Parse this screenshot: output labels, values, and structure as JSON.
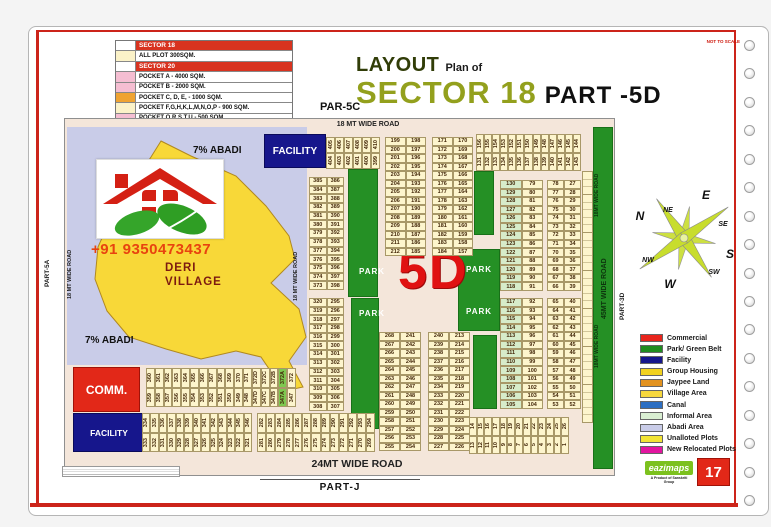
{
  "header": {
    "not_to_scale": "NOT TO SCALE",
    "title_layout": "LAYOUT",
    "title_plan_of": "Plan of",
    "title_sector": "SECTOR 18",
    "title_part": "PART -5D",
    "par5c": "PAR-5C"
  },
  "legend_left": {
    "sections": [
      {
        "header": "SECTOR 18",
        "rows": [
          {
            "label": "ALL PLOT  300SQM.",
            "color": "#fbf2c8"
          }
        ]
      },
      {
        "header": "SECTOR 20",
        "rows": [
          {
            "label": "POCKET A    -  4000 SQM.",
            "color": "#f5bed2"
          },
          {
            "label": "POCKET B    -  2000 SQM.",
            "color": "#f5bed2"
          },
          {
            "label": "POCKET C, D, E,  - 1000 SQM.",
            "color": "#efa332"
          },
          {
            "label": "POCKET  F,G,H,K,L,M,N,O,P  -  900 SQM.",
            "color": "#fbf2c8"
          },
          {
            "label": "POCKET Q,R,S,T,U   -  500 SQM.",
            "color": "#f5bed2"
          }
        ]
      }
    ]
  },
  "legend_right": {
    "items": [
      {
        "label": "Commercial",
        "color": "#e8251c"
      },
      {
        "label": "Park/ Green Belt",
        "color": "#1f8c1f"
      },
      {
        "label": "Facility",
        "color": "#16168c"
      },
      {
        "label": "Group Housing",
        "color": "#f2d21f"
      },
      {
        "label": "Jaypee Land",
        "color": "#e2921f"
      },
      {
        "label": "Village Area",
        "color": "#f6d73e"
      },
      {
        "label": "Canal",
        "color": "#2d6fc2"
      },
      {
        "label": "Informal Area",
        "color": "#d9efd2"
      },
      {
        "label": "Abadi Area",
        "color": "#c9cce8"
      },
      {
        "label": "Unalloted Plots",
        "color": "#f2e435"
      },
      {
        "label": "New Relocated Plots",
        "color": "#e215a0"
      }
    ]
  },
  "sides": {
    "part5a": "PART-5A",
    "part3d": "PART-3D"
  },
  "compass": {
    "n": "N",
    "ne": "NE",
    "e": "E",
    "se": "SE",
    "s": "S",
    "sw": "SW",
    "w": "W",
    "nw": "NW"
  },
  "footer": {
    "part_j": "PART-J",
    "brand": "eazimaps",
    "tagline": "A Product of Sanskriti Group",
    "page_no": "17"
  },
  "map": {
    "labels": {
      "top_road": "18 MT WIDE ROAD",
      "left_road": "18 MT WIDE ROAD",
      "mid_road": "18 MT WIDE ROAD",
      "right_18_top": "18MT WIDE ROAD",
      "right_18_bot": "18MT WIDE ROAD",
      "right_45": "45MT WIDE ROAD",
      "bottom_road": "24MT WIDE ROAD",
      "park": "PARK",
      "big_5d": "5D",
      "facility_top": "FACILITY",
      "comm": "COMM.",
      "facility_bottom": "FACILITY",
      "deri1": "DERI",
      "deri2": "VILLAGE",
      "abadi_top": "7% ABADI",
      "abadi_bottom": "7% ABADI",
      "phone": "+91 9350473437"
    },
    "plots": {
      "top_strip": {
        "dir": "v",
        "pairs": [
          [
            "405",
            "404"
          ],
          [
            "406",
            "403"
          ],
          [
            "407",
            "402"
          ],
          [
            "408",
            "401"
          ],
          [
            "409",
            "400"
          ],
          [
            "410",
            "399"
          ]
        ]
      },
      "colA": {
        "dir": "h",
        "pairs": [
          [
            "385",
            "386"
          ],
          [
            "384",
            "387"
          ],
          [
            "383",
            "388"
          ],
          [
            "382",
            "389"
          ],
          [
            "381",
            "390"
          ],
          [
            "380",
            "391"
          ],
          [
            "379",
            "392"
          ],
          [
            "378",
            "393"
          ],
          [
            "377",
            "394"
          ],
          [
            "376",
            "395"
          ],
          [
            "375",
            "396"
          ],
          [
            "374",
            "397"
          ],
          [
            "373",
            "398"
          ]
        ]
      },
      "colB": {
        "dir": "h",
        "pairs": [
          [
            "320",
            "295"
          ],
          [
            "319",
            "296"
          ],
          [
            "318",
            "297"
          ],
          [
            "317",
            "298"
          ],
          [
            "316",
            "299"
          ],
          [
            "315",
            "300"
          ],
          [
            "314",
            "301"
          ],
          [
            "313",
            "302"
          ],
          [
            "312",
            "303"
          ],
          [
            "311",
            "304"
          ],
          [
            "310",
            "305"
          ],
          [
            "309",
            "306"
          ],
          [
            "308",
            "307"
          ]
        ]
      },
      "colC": {
        "dir": "h",
        "pairs": [
          [
            "199",
            "198"
          ],
          [
            "200",
            "197"
          ],
          [
            "201",
            "196"
          ],
          [
            "202",
            "195"
          ],
          [
            "203",
            "194"
          ],
          [
            "204",
            "193"
          ],
          [
            "205",
            "192"
          ],
          [
            "206",
            "191"
          ],
          [
            "207",
            "190"
          ],
          [
            "208",
            "189"
          ],
          [
            "209",
            "188"
          ],
          [
            "210",
            "187"
          ],
          [
            "211",
            "186"
          ],
          [
            "212",
            "185"
          ]
        ]
      },
      "colD": {
        "dir": "h",
        "pairs": [
          [
            "171",
            "170"
          ],
          [
            "172",
            "169"
          ],
          [
            "173",
            "168"
          ],
          [
            "174",
            "167"
          ],
          [
            "175",
            "166"
          ],
          [
            "176",
            "165"
          ],
          [
            "177",
            "164"
          ],
          [
            "178",
            "163"
          ],
          [
            "179",
            "162"
          ],
          [
            "180",
            "161"
          ],
          [
            "181",
            "160"
          ],
          [
            "182",
            "159"
          ],
          [
            "183",
            "158"
          ],
          [
            "184",
            "157"
          ]
        ]
      },
      "s131": {
        "dir": "v",
        "pairs": [
          [
            "156",
            "131"
          ],
          [
            "155",
            "132"
          ],
          [
            "154",
            "133"
          ],
          [
            "153",
            "134"
          ],
          [
            "152",
            "135"
          ],
          [
            "151",
            "136"
          ],
          [
            "150",
            "137"
          ],
          [
            "149",
            "138"
          ],
          [
            "148",
            "139"
          ],
          [
            "147",
            "140"
          ],
          [
            "146",
            "141"
          ],
          [
            "145",
            "142"
          ],
          [
            "144",
            "143"
          ]
        ]
      },
      "colE1": {
        "dir": "h",
        "tint": "left",
        "pairs": [
          [
            "130",
            "79"
          ],
          [
            "129",
            "80"
          ],
          [
            "128",
            "81"
          ],
          [
            "127",
            "82"
          ],
          [
            "126",
            "83"
          ],
          [
            "125",
            "84"
          ],
          [
            "124",
            "85"
          ],
          [
            "123",
            "86"
          ],
          [
            "122",
            "87"
          ],
          [
            "121",
            "88"
          ],
          [
            "120",
            "89"
          ],
          [
            "119",
            "90"
          ],
          [
            "118",
            "91"
          ]
        ]
      },
      "colE2": {
        "dir": "h",
        "tint": "left",
        "pairs": [
          [
            "117",
            "92"
          ],
          [
            "116",
            "93"
          ],
          [
            "115",
            "94"
          ],
          [
            "114",
            "95"
          ],
          [
            "113",
            "96"
          ],
          [
            "112",
            "97"
          ],
          [
            "111",
            "98"
          ],
          [
            "110",
            "99"
          ],
          [
            "109",
            "100"
          ],
          [
            "108",
            "101"
          ],
          [
            "107",
            "102"
          ],
          [
            "106",
            "103"
          ],
          [
            "105",
            "104"
          ]
        ]
      },
      "colF1": {
        "dir": "h",
        "pairs": [
          [
            "78",
            "27"
          ],
          [
            "77",
            "28"
          ],
          [
            "76",
            "29"
          ],
          [
            "75",
            "30"
          ],
          [
            "74",
            "31"
          ],
          [
            "73",
            "32"
          ],
          [
            "72",
            "33"
          ],
          [
            "71",
            "34"
          ],
          [
            "70",
            "35"
          ],
          [
            "69",
            "36"
          ],
          [
            "68",
            "37"
          ],
          [
            "67",
            "38"
          ],
          [
            "66",
            "39"
          ]
        ]
      },
      "colF2": {
        "dir": "h",
        "pairs": [
          [
            "65",
            "40"
          ],
          [
            "64",
            "41"
          ],
          [
            "63",
            "42"
          ],
          [
            "62",
            "43"
          ],
          [
            "61",
            "44"
          ],
          [
            "60",
            "45"
          ],
          [
            "59",
            "46"
          ],
          [
            "58",
            "47"
          ],
          [
            "57",
            "48"
          ],
          [
            "56",
            "49"
          ],
          [
            "55",
            "50"
          ],
          [
            "54",
            "51"
          ],
          [
            "53",
            "52"
          ]
        ]
      },
      "colG": {
        "dir": "h",
        "pairs": [
          [
            "268",
            "241"
          ],
          [
            "267",
            "242"
          ],
          [
            "266",
            "243"
          ],
          [
            "265",
            "244"
          ],
          [
            "264",
            "245"
          ],
          [
            "263",
            "246"
          ],
          [
            "262",
            "247"
          ],
          [
            "261",
            "248"
          ],
          [
            "260",
            "249"
          ],
          [
            "259",
            "250"
          ],
          [
            "258",
            "251"
          ],
          [
            "257",
            "252"
          ],
          [
            "256",
            "253"
          ],
          [
            "255",
            "254"
          ]
        ]
      },
      "colH": {
        "dir": "h",
        "pairs": [
          [
            "240",
            "213"
          ],
          [
            "239",
            "214"
          ],
          [
            "238",
            "215"
          ],
          [
            "237",
            "216"
          ],
          [
            "236",
            "217"
          ],
          [
            "235",
            "218"
          ],
          [
            "234",
            "219"
          ],
          [
            "233",
            "220"
          ],
          [
            "232",
            "221"
          ],
          [
            "231",
            "222"
          ],
          [
            "230",
            "223"
          ],
          [
            "229",
            "224"
          ],
          [
            "228",
            "225"
          ],
          [
            "227",
            "226"
          ]
        ]
      },
      "g26": {
        "dir": "v",
        "pairs": [
          [
            "14",
            "13"
          ],
          [
            "15",
            "12"
          ],
          [
            "16",
            "11"
          ],
          [
            "17",
            "10"
          ],
          [
            "18",
            "9"
          ],
          [
            "19",
            "8"
          ],
          [
            "20",
            "7"
          ],
          [
            "21",
            "6"
          ],
          [
            "22",
            "5"
          ],
          [
            "23",
            "4"
          ],
          [
            "24",
            "3"
          ],
          [
            "25",
            "2"
          ],
          [
            "26",
            "1"
          ]
        ]
      },
      "s360": {
        "dir": "v",
        "pairs": [
          [
            "360",
            "359"
          ],
          [
            "361",
            "358"
          ],
          [
            "362",
            "357"
          ],
          [
            "363",
            "356"
          ],
          [
            "364",
            "355"
          ],
          [
            "365",
            "354"
          ],
          [
            "366",
            "353"
          ],
          [
            "367",
            "352"
          ],
          [
            "368",
            "351"
          ],
          [
            "369",
            "350"
          ],
          [
            "370",
            "349"
          ],
          [
            "371",
            "348"
          ],
          [
            "372D",
            "347D"
          ],
          [
            "372C",
            "347C"
          ],
          [
            "372B",
            "347B"
          ],
          [
            "372A",
            "347A",
            "g"
          ],
          [
            "372",
            "347"
          ]
        ]
      },
      "s334": {
        "dir": "v",
        "pairs": [
          [
            "334",
            "333"
          ],
          [
            "335",
            "332"
          ],
          [
            "336",
            "331"
          ],
          [
            "337",
            "330"
          ],
          [
            "338",
            "329"
          ],
          [
            "339",
            "328"
          ],
          [
            "340",
            "327"
          ],
          [
            "341",
            "326"
          ],
          [
            "342",
            "325"
          ],
          [
            "343",
            "324"
          ],
          [
            "344",
            "323"
          ],
          [
            "345",
            "322"
          ],
          [
            "346",
            "321"
          ]
        ]
      },
      "s282": {
        "dir": "v",
        "pairs": [
          [
            "282",
            "281"
          ],
          [
            "283",
            "280"
          ],
          [
            "284",
            "279"
          ],
          [
            "285",
            "278"
          ],
          [
            "286",
            "277"
          ],
          [
            "287",
            "276"
          ],
          [
            "288",
            "275"
          ],
          [
            "289",
            "274"
          ],
          [
            "290",
            "273"
          ],
          [
            "291",
            "272"
          ],
          [
            "292",
            "271"
          ],
          [
            "293",
            "270"
          ],
          [
            "294",
            "269"
          ]
        ]
      }
    }
  }
}
